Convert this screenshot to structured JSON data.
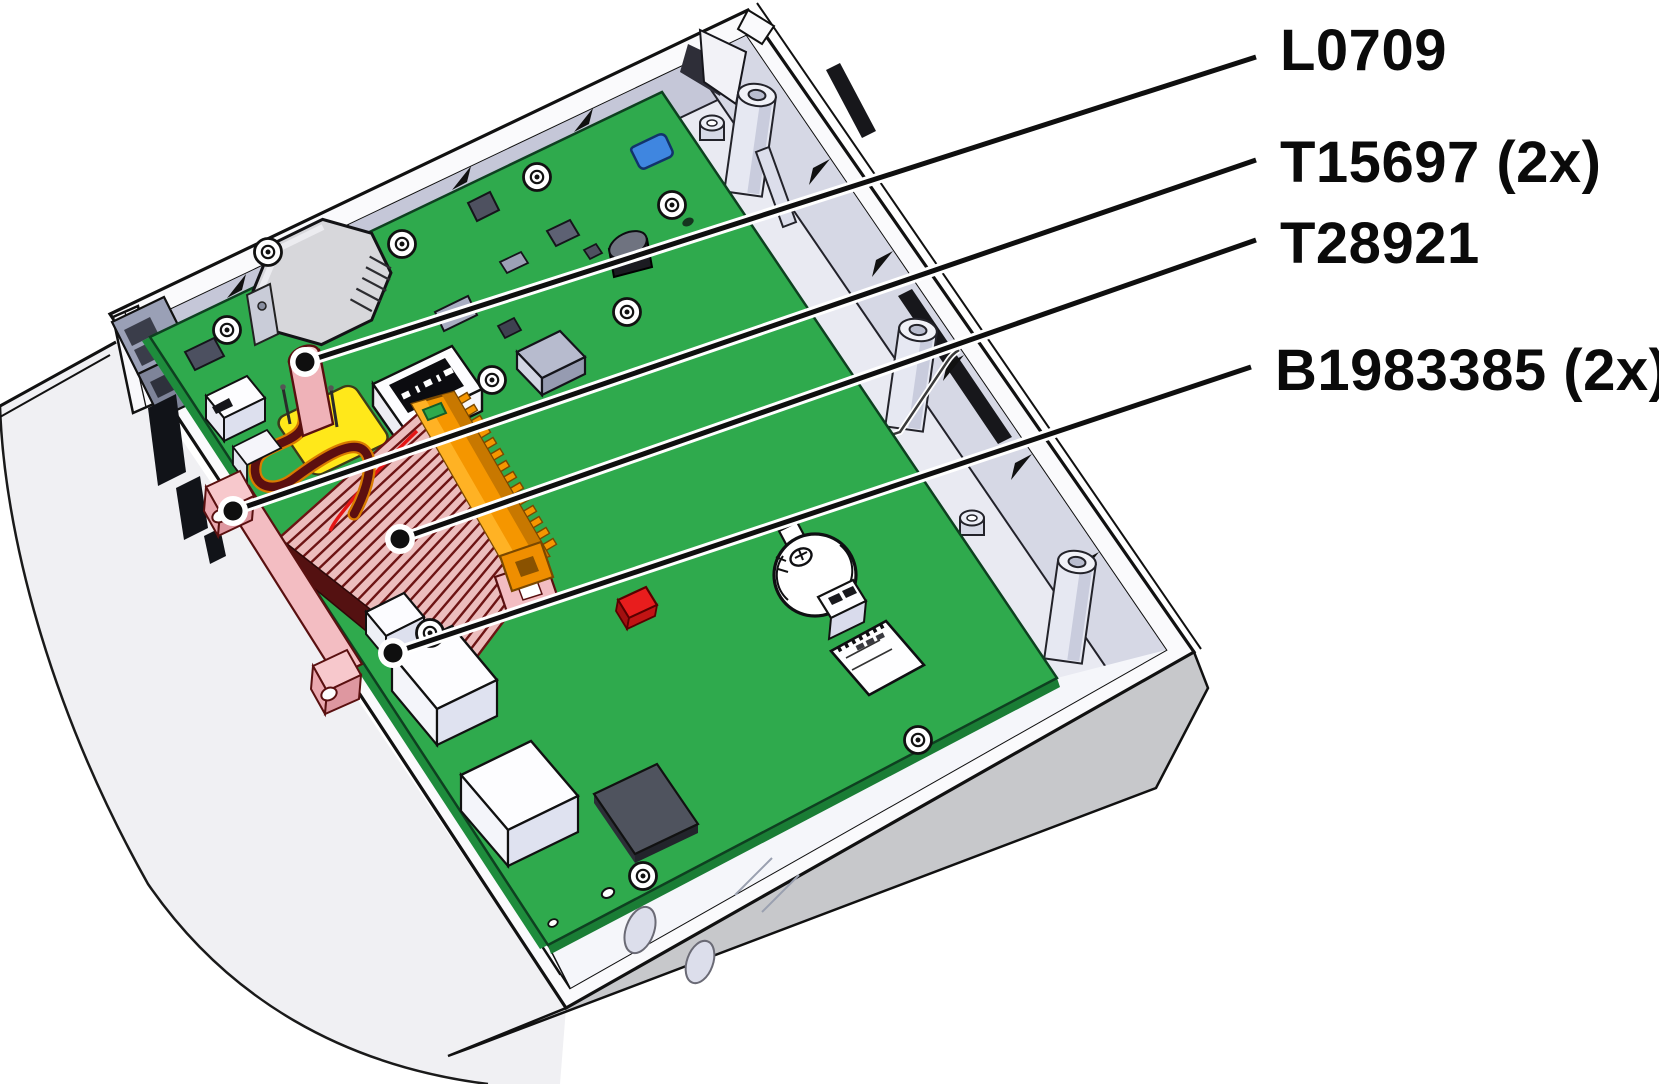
{
  "figure": {
    "type": "technical-illustration",
    "description": "Opened electronics enclosure with green PCB and part callouts",
    "background": "#ffffff",
    "callouts": [
      {
        "id": "L0709",
        "label": "L0709",
        "target_x": 305,
        "target_y": 362,
        "anchor_x": 1256,
        "anchor_y": 57
      },
      {
        "id": "T15697",
        "label": "T15697 (2x)",
        "target_x": 233,
        "target_y": 511,
        "anchor_x": 1256,
        "anchor_y": 160
      },
      {
        "id": "T28921",
        "label": "T28921",
        "target_x": 400,
        "target_y": 539,
        "anchor_x": 1256,
        "anchor_y": 240
      },
      {
        "id": "B1983385",
        "label": "B1983385 (2x)",
        "target_x": 393,
        "target_y": 653,
        "anchor_x": 1251,
        "anchor_y": 367
      }
    ],
    "colors": {
      "pcb_green": "#2faa4d",
      "case_white": "#fafafc",
      "interior_lavender": "#e9eaf2",
      "wall_gray": "#c7c8cb",
      "ribbon_pink": "#ecbdbd",
      "ribbon_maroon": "#541111",
      "heatsink_orange": "#f59600",
      "battery_yellow": "#ffe81a",
      "component_pink": "#f3bdc2",
      "wire_dark_red": "#5c0f10",
      "component_blue": "#3f86e0",
      "component_red": "#e81d1d",
      "line_black": "#111111"
    },
    "label_font_size_px": 58
  }
}
